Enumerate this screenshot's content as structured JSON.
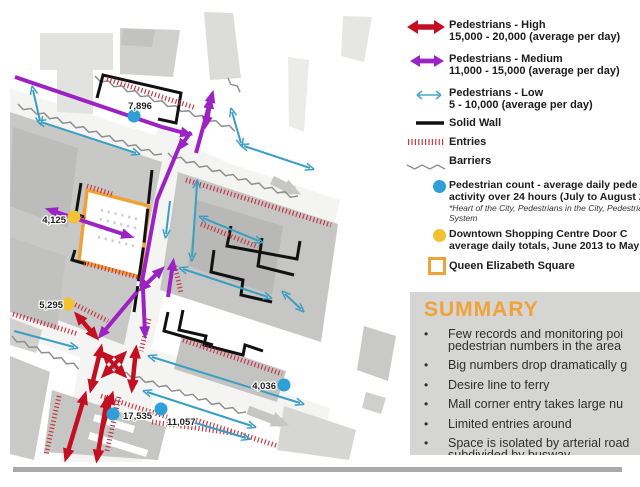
{
  "colors": {
    "high": "#c21022",
    "medium": "#9c22c4",
    "low": "#3b9ec4",
    "count_dot": "#2da0d8",
    "door_dot": "#f2c230",
    "square": "#f0a237",
    "entries": "#c23a4a",
    "barrier": "#8f8f8f",
    "wall": "#111111",
    "summary_bg": "#d5d5d4",
    "accent": "#f0a237"
  },
  "map": {
    "counts": [
      {
        "value": "7,896",
        "type": "pedestrian-count"
      },
      {
        "value": "4,125",
        "type": "door-count"
      },
      {
        "value": "5,295",
        "type": "door-count"
      },
      {
        "value": "17,535",
        "type": "pedestrian-count"
      },
      {
        "value": "11,057",
        "type": "pedestrian-count"
      },
      {
        "value": "4,036",
        "type": "pedestrian-count"
      }
    ]
  },
  "legend": {
    "flows": [
      {
        "label": "Pedestrians - High",
        "range": "15,000 - 20,000 (average per day)"
      },
      {
        "label": "Pedestrians - Medium",
        "range": "11,000 - 15,000 (average per day)"
      },
      {
        "label": "Pedestrians - Low",
        "range": "5 - 10,000 (average per day)"
      }
    ],
    "wall_label": "Solid Wall",
    "entries_label": "Entries",
    "barriers_label": "Barriers",
    "points": [
      {
        "line1": "Pedestrian count - average daily pede",
        "line2": "activity over 24 hours (July to August 2",
        "note1": "*Heart of the City, Pedestrians in the City, Pedestria",
        "note2": "System"
      },
      {
        "line1": "Downtown Shopping Centre Door C",
        "line2": "average daily totals, June 2013 to May 2"
      }
    ],
    "square_label": "Queen Elizabeth Square"
  },
  "summary": {
    "title": "SUMMARY",
    "bullets": [
      {
        "l1": "Few records and monitoring poi",
        "l2": "pedestrian numbers in the area"
      },
      {
        "l1": "Big numbers drop dramatically g",
        "l2": ""
      },
      {
        "l1": "Desire line to ferry",
        "l2": ""
      },
      {
        "l1": "Mall corner entry takes large nu",
        "l2": ""
      },
      {
        "l1": "Limited entries around",
        "l2": ""
      },
      {
        "l1": "Space is isolated by arterial road",
        "l2": "subdivided by busway"
      }
    ]
  }
}
